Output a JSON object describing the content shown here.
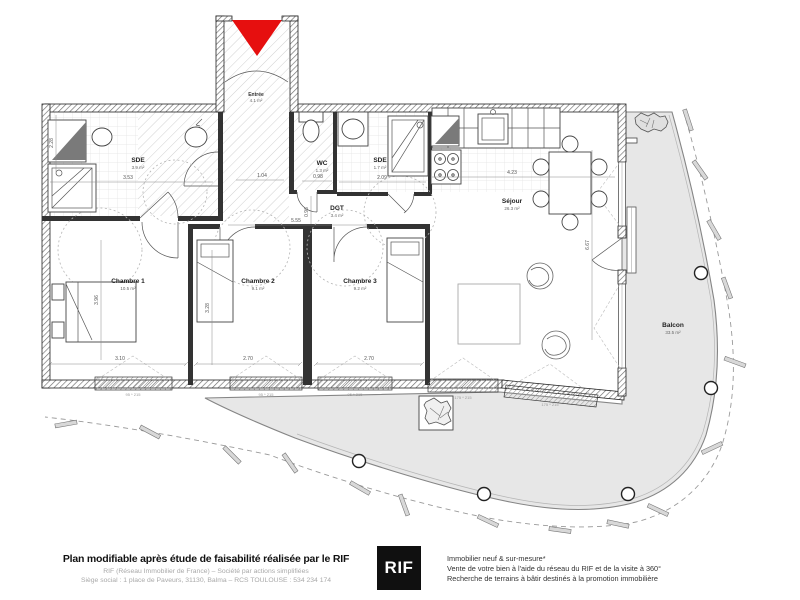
{
  "plan": {
    "colors": {
      "marker": "#e60f0f",
      "balcony": "#e7e7e7",
      "wall": "#1b1b1b"
    },
    "rooms": [
      {
        "name": "Entrée",
        "area": "4.1 m²"
      },
      {
        "name": "SDE",
        "area": "3.9 m²"
      },
      {
        "name": "WC",
        "area": "1.3 m²"
      },
      {
        "name": "SDE",
        "area": "1.7 m²"
      },
      {
        "name": "DGT",
        "area": "3.4 m²"
      },
      {
        "name": "Séjour",
        "area": "26.3 m²"
      },
      {
        "name": "Chambre 1",
        "area": "10.5 m²"
      },
      {
        "name": "Chambre 2",
        "area": "9.1 m²"
      },
      {
        "name": "Chambre 3",
        "area": "9.2 m²"
      },
      {
        "name": "Balcon",
        "area": "33.5 m²"
      }
    ],
    "dimensions": [
      "3.53",
      "1.04",
      "0.98",
      "2.09",
      "4.23",
      "5.55",
      "0.96",
      "3.10",
      "2.70",
      "2.70",
      "3.96",
      "3.28",
      "6.67",
      "2.28"
    ],
    "window_marks": [
      "95 * 215",
      "95 * 215",
      "95 * 215",
      "175 * 215",
      "175 * 215"
    ]
  },
  "footer": {
    "title": "Plan modifiable après étude de faisabilité réalisée par le RIF",
    "company_line1": "RIF (Réseau Immobilier de France) – Société par actions simplifiées",
    "company_line2": "Siège social : 1 place de Paveurs, 31130, Balma – RCS TOULOUSE : 534 234 174",
    "logo": "RIF",
    "services": [
      "Immobilier neuf & sur-mesure*",
      "Vente de votre bien à l'aide du réseau du RIF et de la visite à 360°",
      "Recherche de terrains à bâtir destinés à la promotion immobilière"
    ]
  }
}
